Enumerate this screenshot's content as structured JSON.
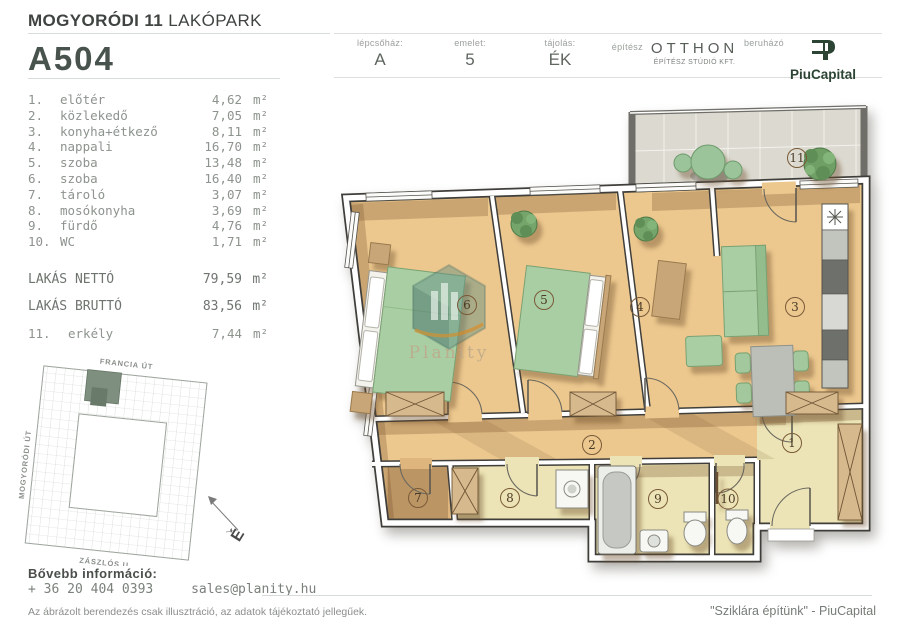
{
  "header": {
    "project_bold": "MOGYORÓDI 11",
    "project_light": "LAKÓPARK",
    "unit_id": "A504",
    "fields": [
      {
        "label": "lépcsőház:",
        "value": "A"
      },
      {
        "label": "emelet:",
        "value": "5"
      },
      {
        "label": "tájolás:",
        "value": "ÉK"
      }
    ],
    "architect_label": "építész",
    "architect_name": "OTTHON",
    "architect_sub": "ÉPÍTÉSZ STÚDIÓ KFT.",
    "developer_label": "beruházó",
    "developer_name": "PiuCapital"
  },
  "unit_label": "m²",
  "rooms": [
    {
      "num": "1.",
      "name": "előtér",
      "area": "4,62"
    },
    {
      "num": "2.",
      "name": "közlekedő",
      "area": "7,05"
    },
    {
      "num": "3.",
      "name": "konyha+étkező",
      "area": "8,11"
    },
    {
      "num": "4.",
      "name": "nappali",
      "area": "16,70"
    },
    {
      "num": "5.",
      "name": "szoba",
      "area": "13,48"
    },
    {
      "num": "6.",
      "name": "szoba",
      "area": "16,40"
    },
    {
      "num": "7.",
      "name": "tároló",
      "area": "3,07"
    },
    {
      "num": "8.",
      "name": "mosókonyha",
      "area": "3,69"
    },
    {
      "num": "9.",
      "name": "fürdő",
      "area": "4,76"
    },
    {
      "num": "10.",
      "name": "WC",
      "area": "1,71"
    }
  ],
  "totals": [
    {
      "label": "LAKÁS NETTÓ",
      "area": "79,59"
    },
    {
      "label": "LAKÁS BRUTTÓ",
      "area": "83,56"
    }
  ],
  "balcony": {
    "num": "11.",
    "name": "erkély",
    "area": "7,44"
  },
  "minimap": {
    "street_top": "FRANCIA ÚT",
    "street_left": "MOGYORÓDI ÚT",
    "street_bottom": "ZÁSZLÓS U.",
    "compass": "É"
  },
  "plan": {
    "watermark": "Planity",
    "labels": [
      "1",
      "2",
      "3",
      "4",
      "5",
      "6",
      "7",
      "8",
      "9",
      "10",
      "11"
    ]
  },
  "footer": {
    "info_label": "Bővebb információ:",
    "phone": "+ 36 20 404 0393",
    "email": "sales@planity.hu",
    "disclaimer": "Az ábrázolt berendezés csak illusztráció, az adatok tájékoztató jellegűek.",
    "quote": "\"Sziklára építünk\" - PiuCapital"
  },
  "colors": {
    "wood_floor": "#ecc88f",
    "tile_floor": "#ece4b6",
    "furniture_green": "#a9cea3",
    "wall": "#3f3e3a",
    "brand_green": "#2c4434"
  }
}
